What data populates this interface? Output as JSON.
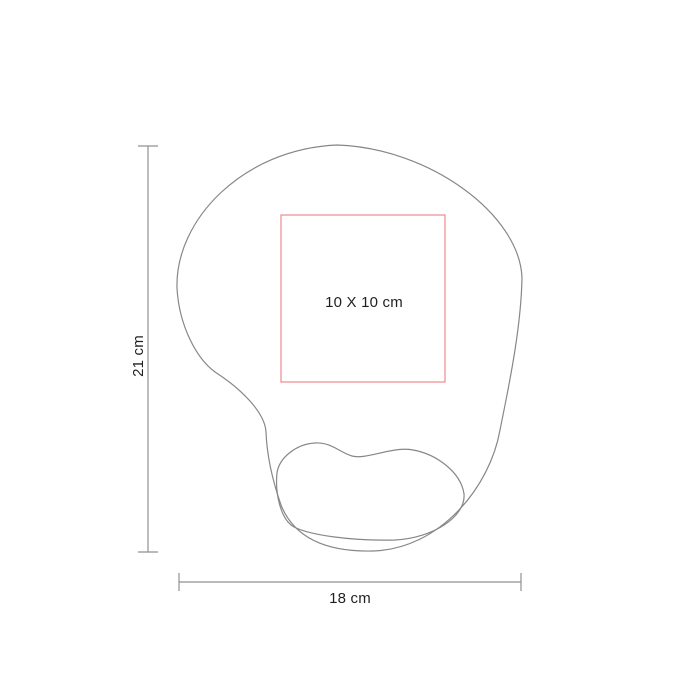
{
  "canvas": {
    "width": 700,
    "height": 700,
    "background": "#ffffff"
  },
  "diagram": {
    "type": "product-dimension-diagram",
    "subject": "ergonomic mousepad with wrist rest (top view)",
    "labels": {
      "print_area": "10 X 10 cm",
      "height": "21 cm",
      "width": "18 cm"
    },
    "colors": {
      "outline": "#85878a",
      "dimension": "#8f9194",
      "print_area": "#ef8a8e",
      "text": "#231f20",
      "background": "#ffffff"
    }
  }
}
